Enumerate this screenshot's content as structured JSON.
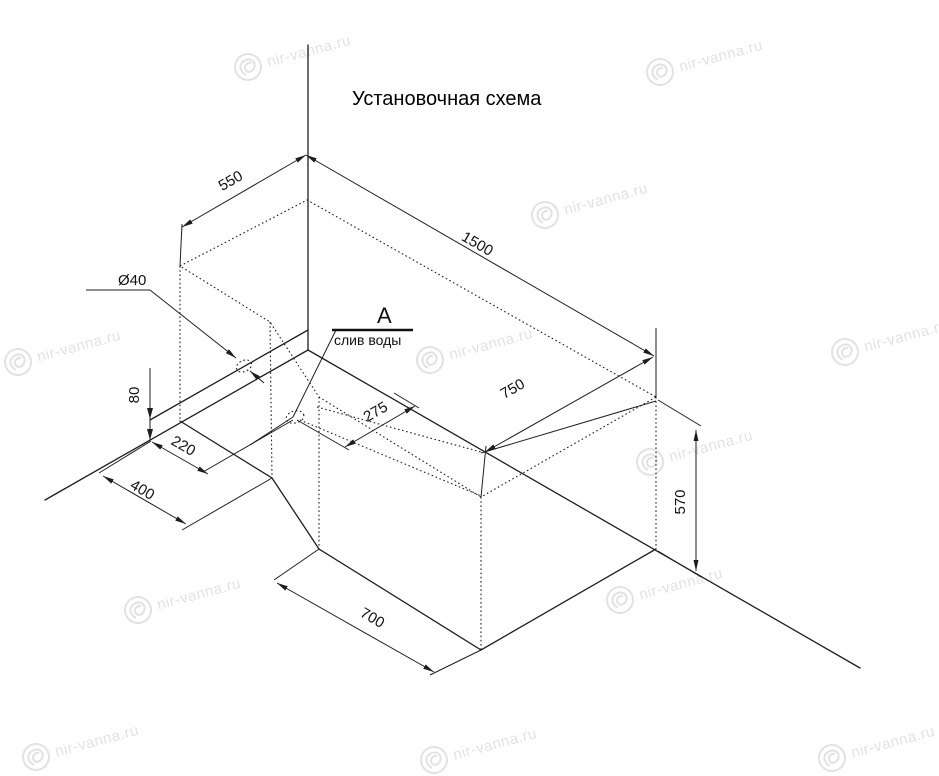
{
  "title": "Установочная схема",
  "colors": {
    "ink": "#1e1e1e",
    "watermark": "#e2e2e2"
  },
  "drawing": {
    "type": "isometric installation scheme of corner bathtub",
    "dims": {
      "corner_width": "550",
      "length": "1500",
      "depth": "750",
      "height": "570",
      "step_length": "700",
      "step_depth": "400",
      "drain_from_wall": "220",
      "base_height": "80",
      "drain_from_edge": "275",
      "drain_diameter": "Ø40"
    },
    "labels": {
      "view_label": "A",
      "drain_label": "слив воды"
    }
  },
  "watermark": {
    "text": "nir-vanna.ru",
    "rotation_deg": -15,
    "positions": [
      [
        248,
        67
      ],
      [
        660,
        72
      ],
      [
        545,
        215
      ],
      [
        18,
        362
      ],
      [
        430,
        360
      ],
      [
        845,
        352
      ],
      [
        650,
        462
      ],
      [
        138,
        610
      ],
      [
        620,
        600
      ],
      [
        36,
        757
      ],
      [
        434,
        760
      ],
      [
        832,
        758
      ]
    ]
  }
}
